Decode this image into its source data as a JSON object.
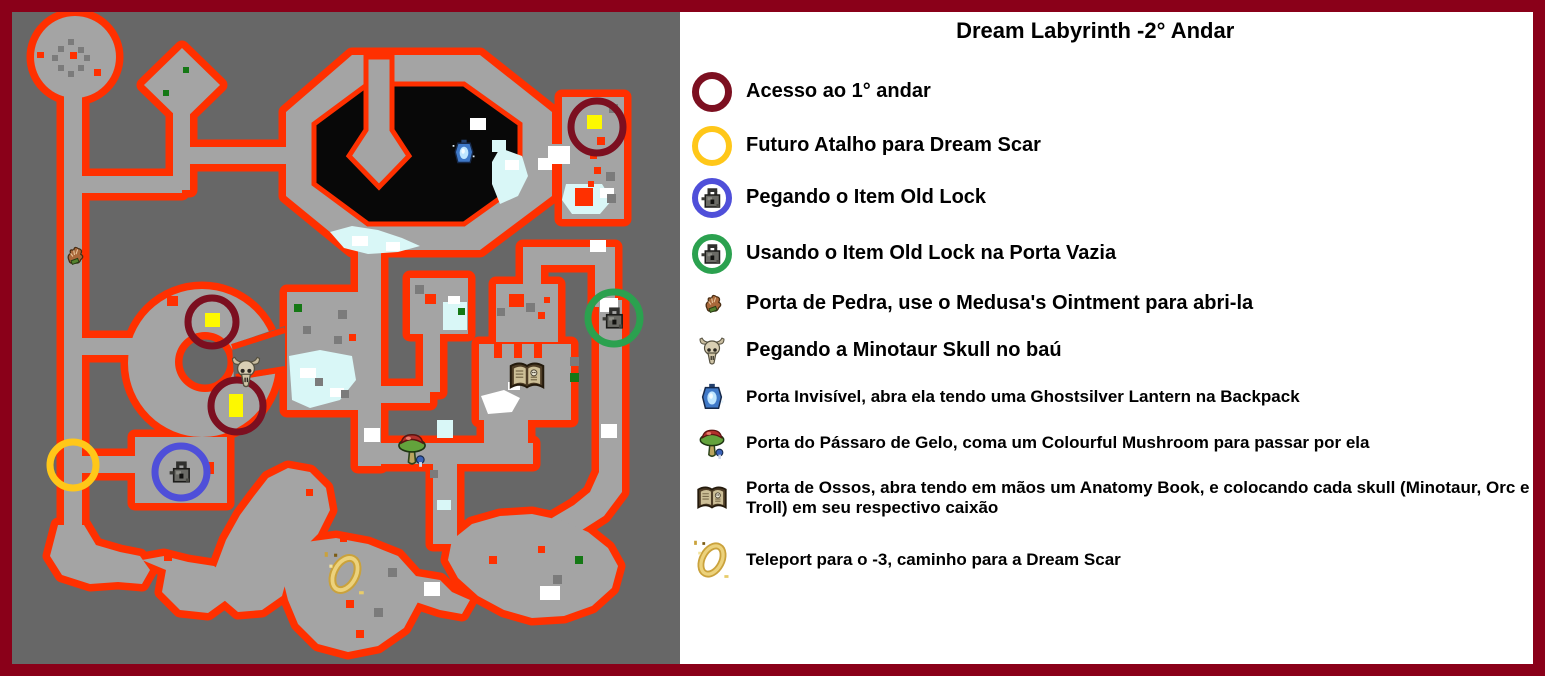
{
  "title": "Dream Labyrinth -2° Andar",
  "legend": {
    "items": [
      {
        "icon": "maroon-circle",
        "color": "#7c0f20",
        "label": "Acesso ao 1° andar"
      },
      {
        "icon": "yellow-circle",
        "color": "#ffc719",
        "label": "Futuro Atalho para Dream Scar"
      },
      {
        "icon": "blue-circle-old-lock",
        "color": "#4f4fd9",
        "label": "Pegando o Item Old Lock"
      },
      {
        "icon": "green-circle-old-lock",
        "color": "#2ba14f",
        "label": "Usando o Item Old Lock na Porta Vazia"
      },
      {
        "icon": "medusa-ointment",
        "color": "#a9683a",
        "label": "Porta de Pedra, use o Medusa's Ointment para abri-la"
      },
      {
        "icon": "minotaur-skull",
        "color": "#d9cfb4",
        "label": "Pegando a Minotaur Skull no baú"
      },
      {
        "icon": "ghostsilver-lantern",
        "color": "#3f79c8",
        "label": "Porta Invisível, abra ela tendo uma Ghostsilver Lantern na Backpack"
      },
      {
        "icon": "colourful-mushroom",
        "color": "#b3302c",
        "label": "Porta do Pássaro de Gelo, coma um Colourful Mushroom para passar por ela"
      },
      {
        "icon": "anatomy-book",
        "color": "#4e3d26",
        "label": "Porta de Ossos, abra tendo em mãos um Anatomy Book, e colocando cada skull (Minotaur, Orc e Troll) em seu respectivo caixão"
      },
      {
        "icon": "teleport-ring",
        "color": "#caa23c",
        "label": "Teleport para o -3, caminho para a Dream Scar"
      }
    ]
  },
  "map": {
    "background_color": "#676767",
    "wall_color": "#ff3000",
    "floor_color": "#a4a4a4",
    "void_color": "#080808",
    "frame_color": "#8a0019",
    "marker_counts": {
      "maroon-circle": 3,
      "yellow-circle": 1,
      "blue-circle-old-lock": 1,
      "green-circle-old-lock": 1,
      "medusa-ointment": 1,
      "minotaur-skull": 1,
      "ghostsilver-lantern": 1,
      "colourful-mushroom": 1,
      "anatomy-book": 1,
      "teleport-ring": 1
    }
  }
}
